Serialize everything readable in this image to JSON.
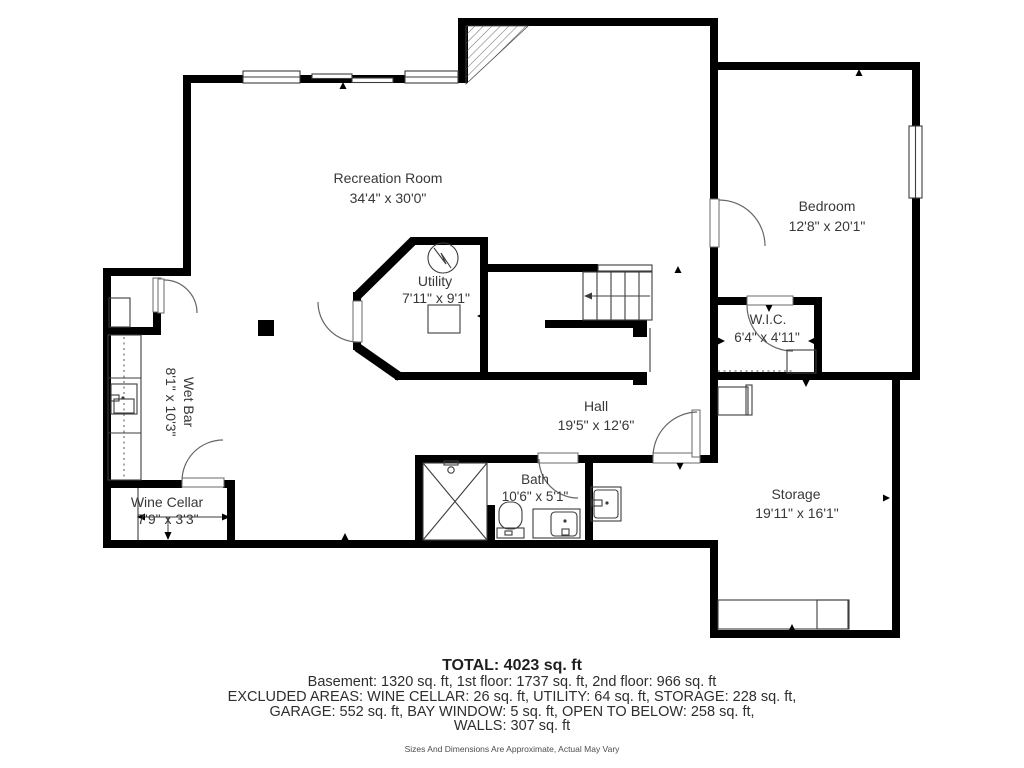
{
  "rooms": {
    "recreation": {
      "name": "Recreation Room",
      "dims": "34'4\" x 30'0\""
    },
    "utility": {
      "name": "Utility",
      "dims": "7'11\" x 9'1\""
    },
    "bedroom": {
      "name": "Bedroom",
      "dims": "12'8\" x 20'1\""
    },
    "wic": {
      "name": "W.I.C.",
      "dims": "6'4\" x 4'11\""
    },
    "hall": {
      "name": "Hall",
      "dims": "19'5\" x 12'6\""
    },
    "wetbar": {
      "name": "Wet Bar",
      "dims": "8'1\" x 10'3\""
    },
    "winecellar": {
      "name": "Wine Cellar",
      "dims": "7'9\" x 3'3\""
    },
    "bath": {
      "name": "Bath",
      "dims": "10'6\" x 5'1\""
    },
    "storage": {
      "name": "Storage",
      "dims": "19'11\" x 16'1\""
    }
  },
  "footer": {
    "total": "TOTAL: 4023 sq. ft",
    "line1": "Basement: 1320 sq. ft, 1st floor: 1737 sq. ft, 2nd floor: 966 sq. ft",
    "line2": "EXCLUDED AREAS: WINE CELLAR: 26 sq. ft, UTILITY: 64 sq. ft, STORAGE: 228 sq. ft,",
    "line3": "GARAGE: 552 sq. ft, BAY WINDOW: 5 sq. ft, OPEN TO BELOW: 258 sq. ft,",
    "line4": "WALLS: 307 sq. ft",
    "disclaimer": "Sizes And Dimensions Are Approximate, Actual May Vary"
  },
  "colors": {
    "wall": "#000000",
    "text": "#383838",
    "thin_line": "#3c3c3c",
    "background": "#ffffff"
  }
}
